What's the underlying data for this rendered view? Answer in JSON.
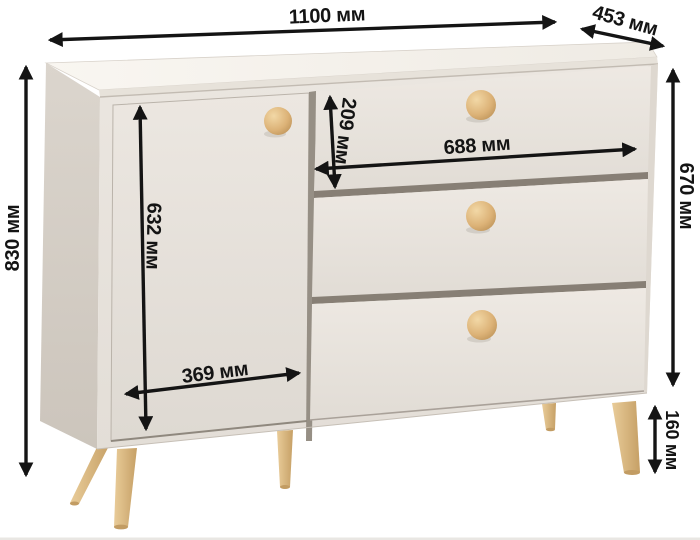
{
  "diagram": {
    "type": "furniture-dimension-diagram",
    "subject": "chest of drawers with door, three drawers and tapered wooden legs",
    "unit": "мм",
    "dimensions": {
      "overall_width": {
        "label": "1100 мм",
        "value": 1100
      },
      "overall_depth": {
        "label": "453 мм",
        "value": 453
      },
      "overall_height": {
        "label": "830 мм",
        "value": 830
      },
      "door_height": {
        "label": "632 мм",
        "value": 632
      },
      "top_drawer_height": {
        "label": "209 мм",
        "value": 209
      },
      "drawer_width": {
        "label": "688 мм",
        "value": 688
      },
      "door_width": {
        "label": "369 мм",
        "value": 369
      },
      "carcass_height": {
        "label": "670 мм",
        "value": 670
      },
      "leg_height": {
        "label": "160 мм",
        "value": 160
      }
    },
    "colors": {
      "body": "#ece8e2",
      "side_panel": "#d5cfc7",
      "wood_accent": "#d8b277",
      "dimension_lines": "#141414",
      "background": "#ffffff"
    }
  }
}
